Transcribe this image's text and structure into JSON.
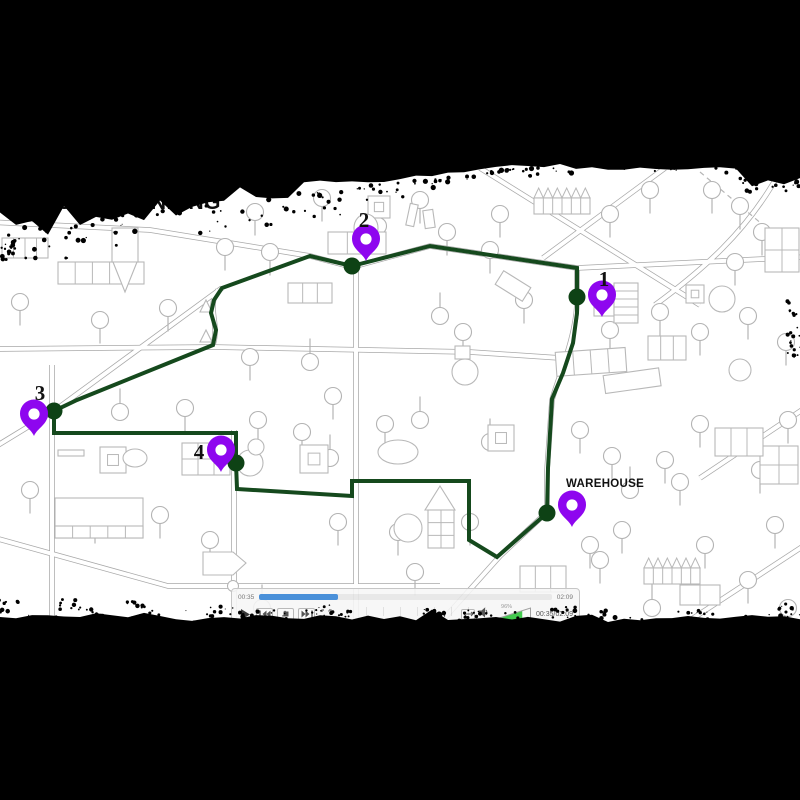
{
  "title": "ROUTE PLANNING",
  "map": {
    "stops": [
      {
        "id": 1,
        "label": "1"
      },
      {
        "id": 2,
        "label": "2"
      },
      {
        "id": 3,
        "label": "3"
      },
      {
        "id": 4,
        "label": "4"
      }
    ],
    "warehouse_label": "WAREHOUSE",
    "colors": {
      "route": "#15491d",
      "node": "#0e4215",
      "pin": "#8e06ef"
    }
  },
  "player": {
    "elapsed_label": "00:35",
    "duration_label": "02:09",
    "time_display": "00:35/02:09",
    "progress_pct": 27,
    "volume_pct_label": "96%",
    "volume_fill_pct": 78,
    "colors": {
      "progress": "#4a90d9",
      "volume": "#43c94f"
    },
    "icons": {
      "play": "play-triangle",
      "prev": "previous-frame",
      "stop": "stop-square",
      "next": "next-frame",
      "fullscreen": "expand-corners",
      "fit": "horizontal-arrows",
      "speaker": "speaker",
      "volume": "volume-wedge"
    }
  }
}
